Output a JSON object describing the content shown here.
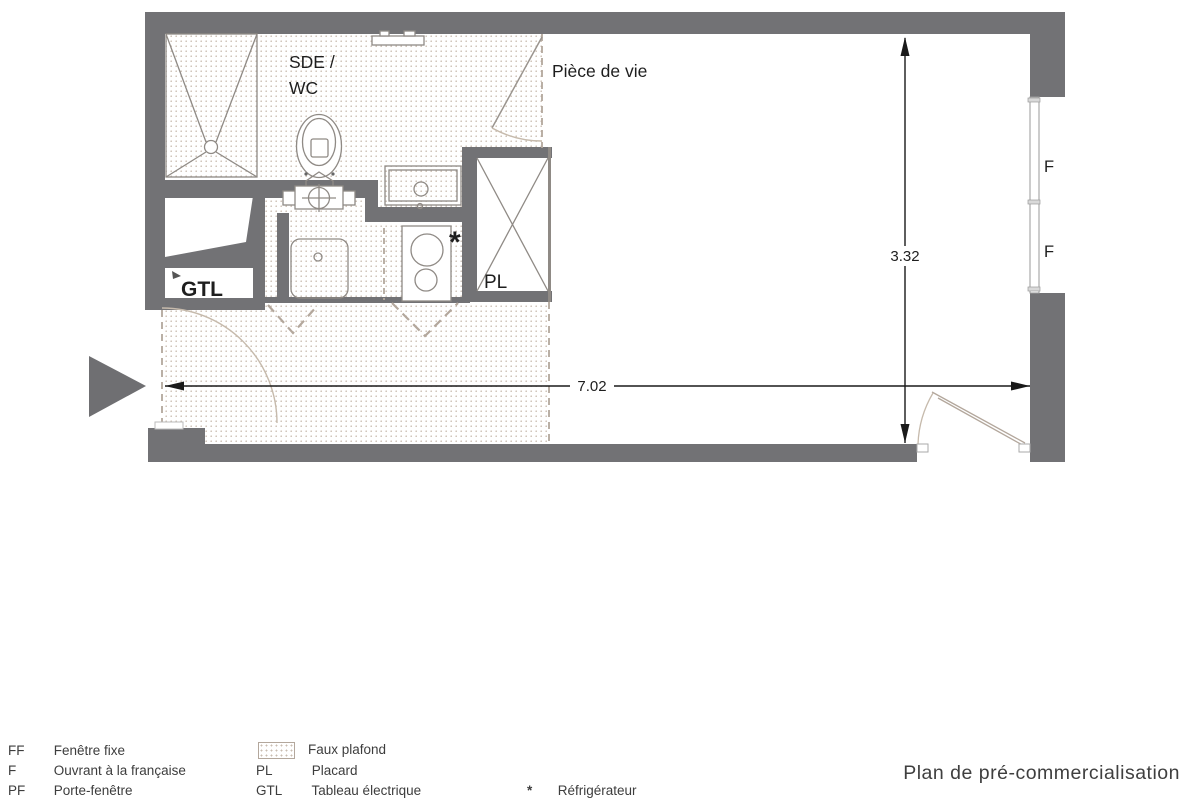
{
  "doc": {
    "title": "Plan de pré-commercialisation",
    "type": "floor-plan"
  },
  "plan": {
    "rooms": {
      "sde_wc_line1": "SDE /",
      "sde_wc_line2": "WC",
      "living": "Pièce de vie"
    },
    "features": {
      "gtl": "GTL",
      "placard": "PL",
      "window_f_top": "F",
      "window_f_bottom": "F",
      "fridge_marker": "*"
    },
    "dimensions": {
      "width_m": "7.02",
      "height_m": "3.32"
    }
  },
  "legend": {
    "abbreviations": [
      {
        "abbr": "FF",
        "label": "Fenêtre fixe"
      },
      {
        "abbr": "F",
        "label": "Ouvrant à la française"
      },
      {
        "abbr": "PF",
        "label": "Porte-fenêtre"
      }
    ],
    "symbols": [
      {
        "abbr": "",
        "label": "Faux plafond"
      },
      {
        "abbr": "PL",
        "label": "Placard"
      },
      {
        "abbr": "GTL",
        "label": "Tableau électrique"
      }
    ],
    "markers": [
      {
        "abbr": "*",
        "label": "Réfrigérateur"
      }
    ]
  },
  "colors": {
    "wall": "#727275",
    "dashed_line": "#b3a79c",
    "ceiling_dots": "#c9bcb0",
    "door_arc": "#c6baac",
    "furniture_line": "#8f8a85",
    "dimension_line": "#1a1a1a",
    "text": "#1f1f1f"
  }
}
